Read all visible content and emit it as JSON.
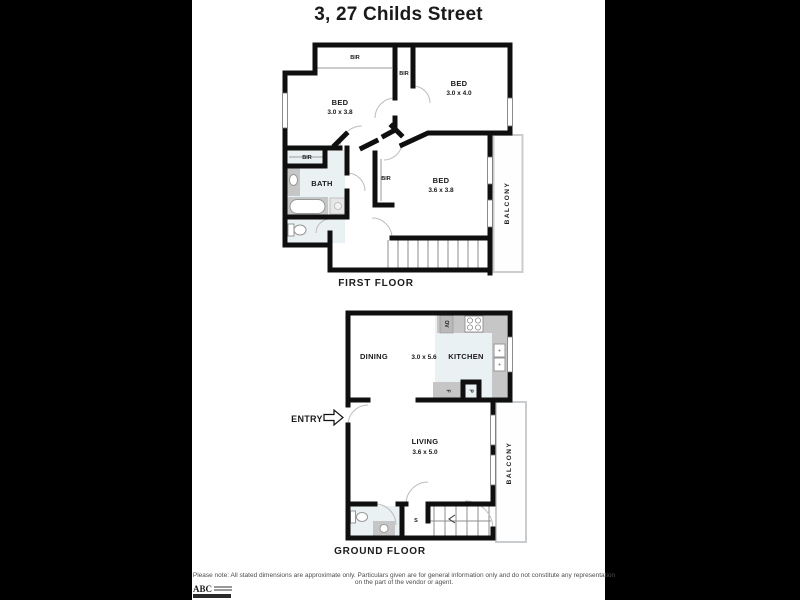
{
  "title": "3, 27 Childs Street",
  "first_floor": {
    "caption": "FIRST FLOOR",
    "bed1_label": "BED",
    "bed1_dims": "3.0 x 3.8",
    "bed2_label": "BED",
    "bed2_dims": "3.0 x 4.0",
    "bed3_label": "BED",
    "bed3_dims": "3.6 x 3.8",
    "bath_label": "BATH",
    "balcony_label": "BALCONY",
    "bir_top_label": "BIR",
    "bir_mid_label": "BIR",
    "bir_left_label": "BIR",
    "bir_bed3_label": "BIR"
  },
  "ground_floor": {
    "caption": "GROUND FLOOR",
    "entry_label": "ENTRY",
    "dining_label": "DINING",
    "dining_kitchen_dims": "3.0 x 5.6",
    "kitchen_label": "KITCHEN",
    "living_label": "LIVING",
    "living_dims": "3.6 x 5.0",
    "balcony_label": "BALCONY",
    "storage_label": "S",
    "oven_label": "OV",
    "fridge_label": "F",
    "pantry_label": "P"
  },
  "footer": {
    "disclaimer": "Please note: All stated dimensions are approximate only. Particulars given are for general information only and do not constitute any representation on the part of the vendor or agent.",
    "logo_text": "ABC"
  }
}
